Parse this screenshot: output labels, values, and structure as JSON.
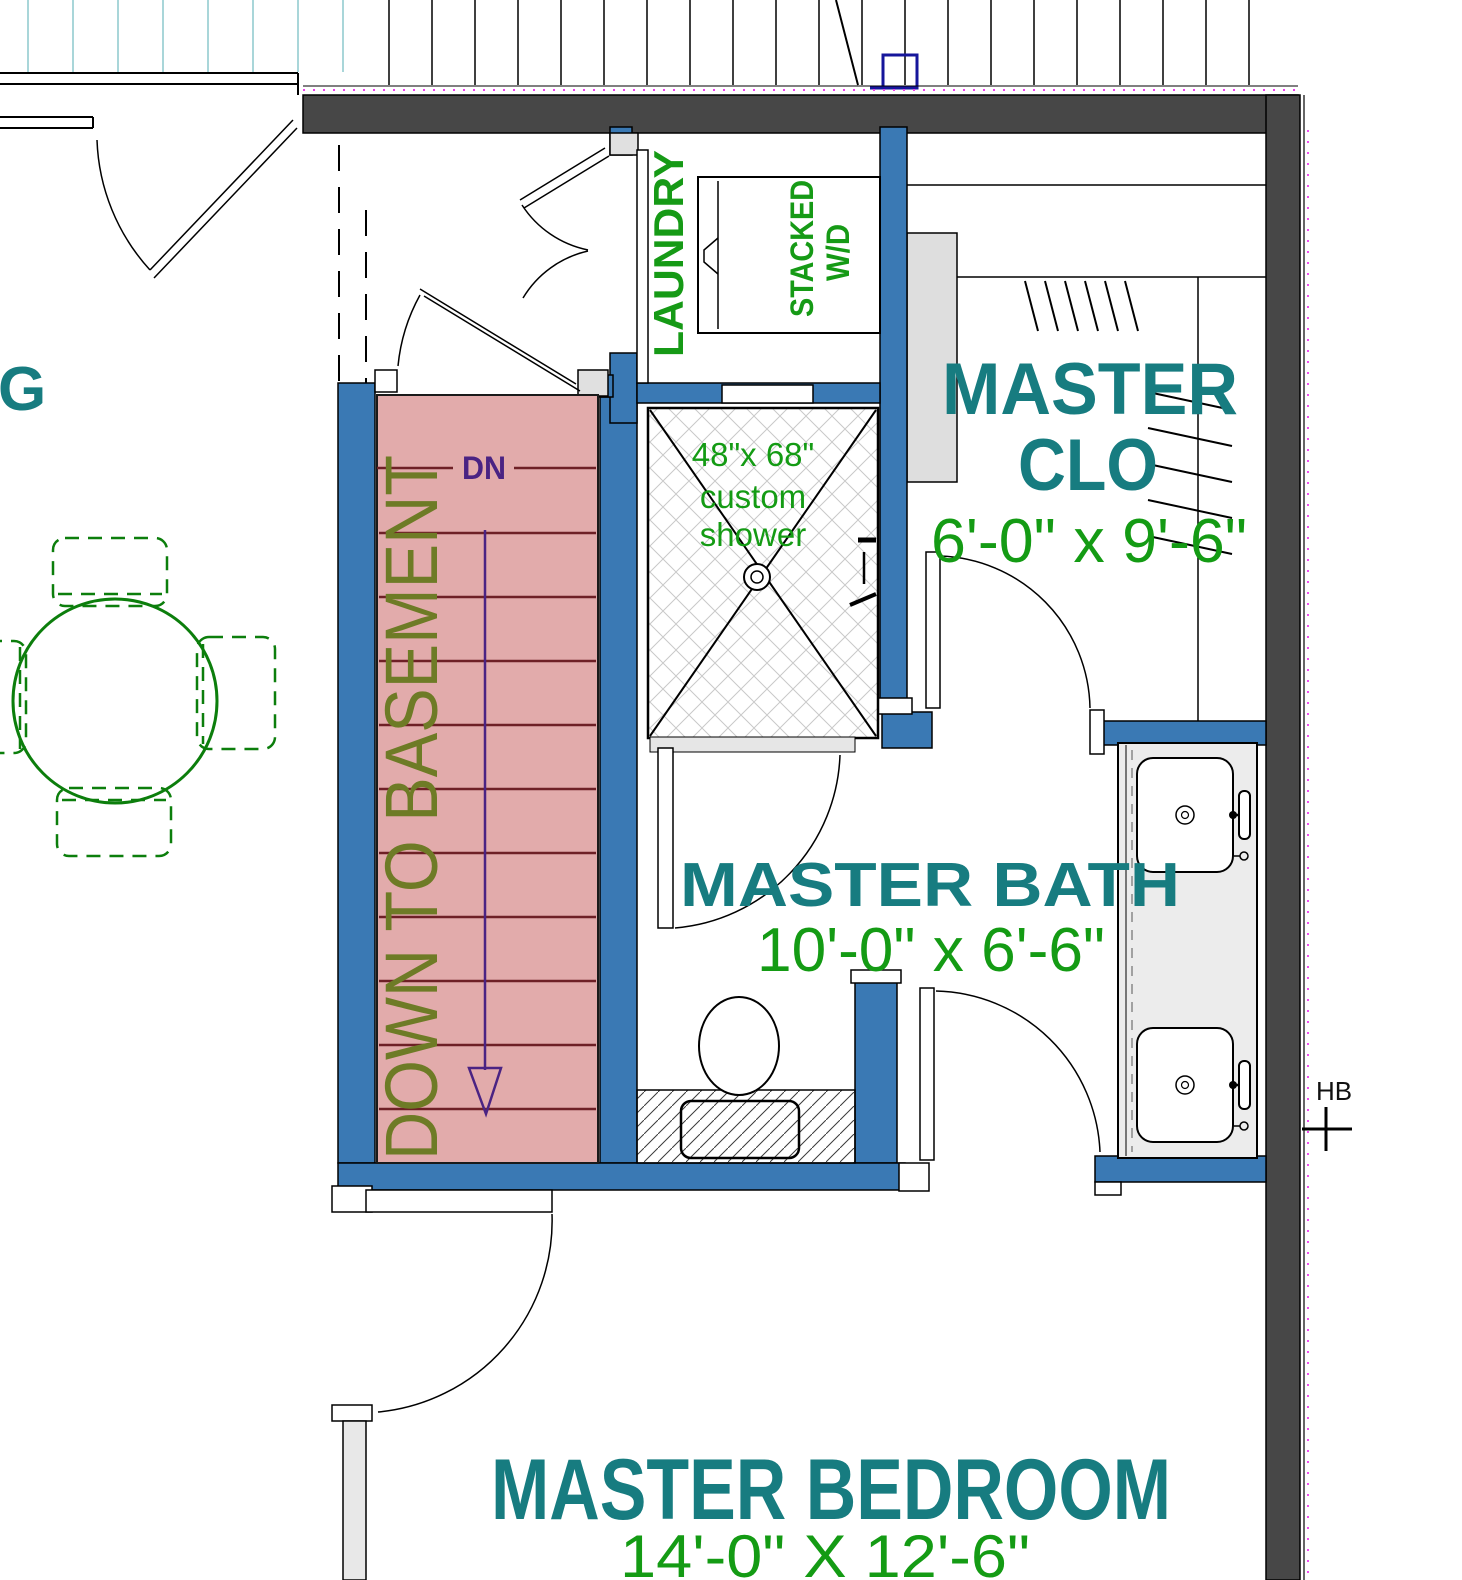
{
  "colors": {
    "room_label_teal": "#177c80",
    "dimension_green": "#149b14",
    "annotation_green": "#169a16",
    "stair_note_olive": "#6e7b26",
    "stair_direction_purple": "#4a2383",
    "stair_fill_pink": "#e2abab",
    "stair_tread_red": "#6e2026",
    "interior_wall_blue": "#3a79b4",
    "exterior_wall_gray": "#474747",
    "deck_board_cyan": "#a9d6d9",
    "deck_post_navy": "#16169b",
    "layer_magenta": "#ef3cef"
  },
  "plan": {
    "rooms": {
      "dining": {
        "partial_label": "G"
      },
      "laundry": {
        "label": "LAUNDRY",
        "equipment_line1": "STACKED",
        "equipment_line2": "W/D"
      },
      "closet": {
        "name_line1": "MASTER",
        "name_line2": "CLO",
        "dims": "6'-0\" x 9'-6\""
      },
      "bath": {
        "name": "MASTER BATH",
        "dims": "10'-0\" x 6'-6\""
      },
      "bedroom": {
        "name": "MASTER BEDROOM",
        "dims": "14'-0\" X 12'-6\""
      }
    },
    "stairs": {
      "direction_label": "DN",
      "note": "DOWN TO BASEMENT"
    },
    "shower": {
      "line1": "48\"x 68\"",
      "line2": "custom",
      "line3": "shower"
    },
    "fixtures": {
      "hose_bib_label": "HB"
    }
  }
}
